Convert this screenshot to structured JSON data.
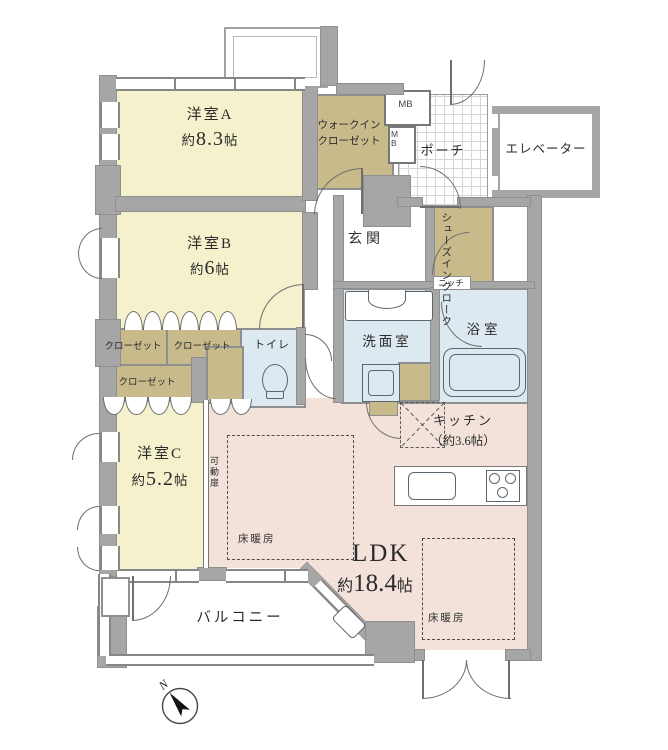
{
  "floorplan": {
    "rooms": {
      "room_a": {
        "label": "洋室A",
        "area_prefix": "約",
        "area_value": "8.3",
        "area_unit": "帖"
      },
      "room_b": {
        "label": "洋室B",
        "area_prefix": "約",
        "area_value": "6",
        "area_unit": "帖"
      },
      "room_c": {
        "label": "洋室C",
        "area_prefix": "約",
        "area_value": "5.2",
        "area_unit": "帖"
      },
      "ldk": {
        "label": "LDK",
        "area_prefix": "約",
        "area_value": "18.4",
        "area_unit": "帖"
      },
      "kitchen": {
        "label": "キッチン",
        "area": "（約3.6帖）"
      },
      "walk_in_closet": {
        "label": "ウォークインクローゼット"
      },
      "shoes_in_cloak": {
        "label": "シューズインクローク"
      },
      "porch": {
        "label": "ポーチ"
      },
      "elevator": {
        "label": "エレベーター"
      },
      "entrance": {
        "label": "玄関"
      },
      "washroom": {
        "label": "洗面室"
      },
      "bathroom": {
        "label": "浴室"
      },
      "toilet": {
        "label": "トイレ"
      },
      "balcony": {
        "label": "バルコニー"
      },
      "closet": {
        "label": "クローゼット"
      }
    },
    "annotations": {
      "meter_box": "MB",
      "niche": "ニッチ",
      "movable_door": "可動扉",
      "floor_heating": "床暖房",
      "compass_north": "N"
    },
    "colors": {
      "wall": "#a6a6a6",
      "western_room": "#f5f1cd",
      "storage": "#c8ba8a",
      "wet_area": "#dde9f1",
      "ldk": "#f2e2d9"
    }
  }
}
